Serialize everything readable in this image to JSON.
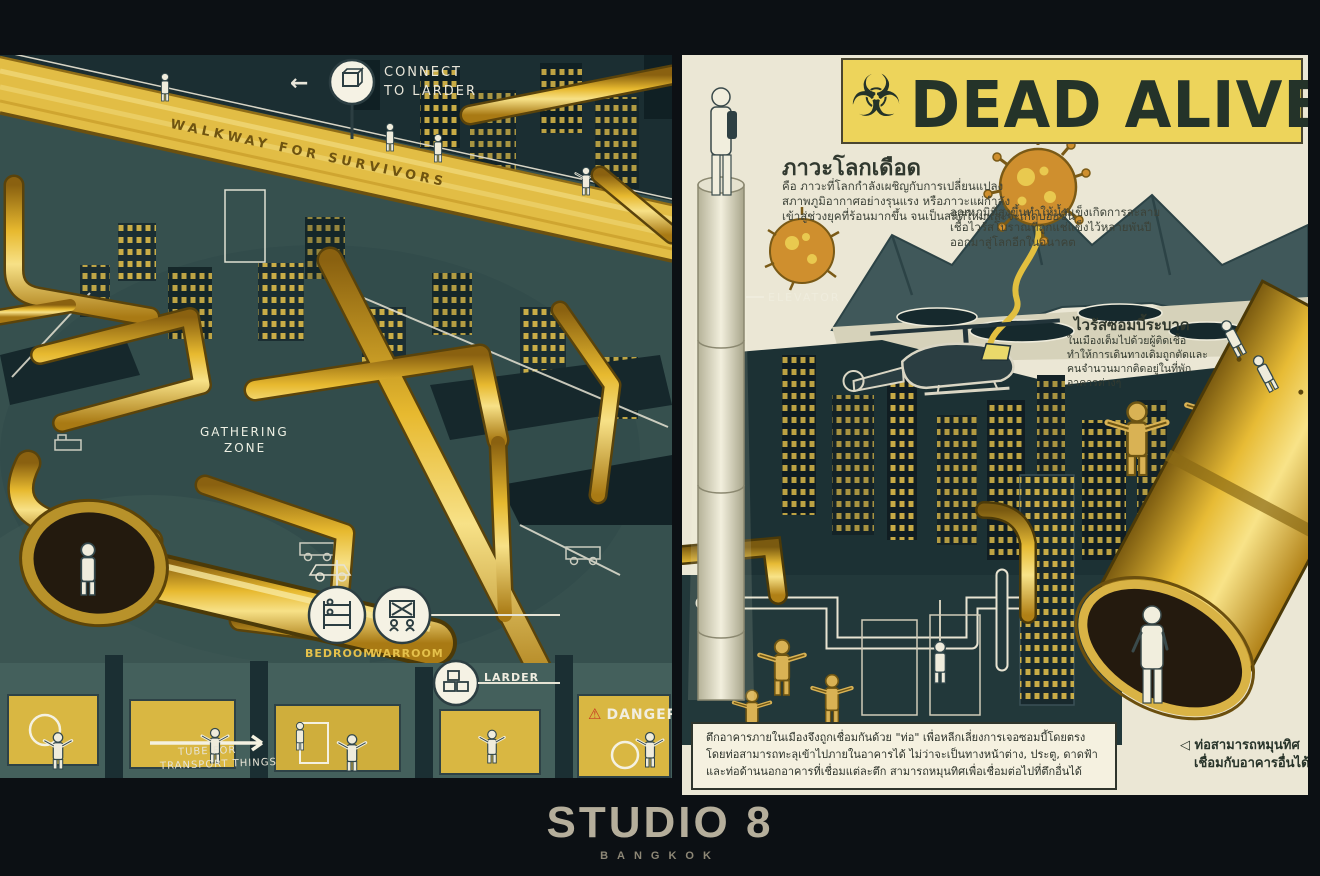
{
  "colors": {
    "background": "#0c1014",
    "pipe_gold": "#e2b93a",
    "scene_teal": "#36504e",
    "paper_cream": "#ebe7d5",
    "banner_yellow": "#edd45b",
    "title_ink": "#243329",
    "danger_red": "#c63b22",
    "studio_text": "#b5ae9b"
  },
  "icons": {
    "biohazard": "☣",
    "arrow_left": "←",
    "warning": "⚠"
  },
  "left_panel": {
    "connect_sign": {
      "line1": "CONNECT",
      "line2": "TO LARDER"
    },
    "walkway_label": "WALKWAY  FOR  SURVIVORS",
    "gathering_zone": {
      "line1": "GATHERING",
      "line2": "ZONE"
    },
    "stations": {
      "bedroom": "BEDROOM",
      "warroom": "WARROOM",
      "larder": "LARDER"
    },
    "danger_label": "DANGER",
    "tube_note": {
      "line1": "TUBE FOR",
      "line2": "TRANSPORT THINGS"
    }
  },
  "right_panel": {
    "title": "DEAD ALIVE",
    "global_boiling": {
      "heading": "ภาวะโลกเดือด",
      "lines": [
        "คือ ภาวะที่โลกกำลังเผชิญกับการเปลี่ยนแปลง",
        "สภาพภูมิอากาศอย่างรุนแรง หรือภาวะแผ่กำลัง",
        "เข้าสู่ช่วงยุคที่ร้อนมากขึ้น จนเป็นสถิติใหม่และจะเกิดบ่อยขึ้น"
      ]
    },
    "melt_note": {
      "lines": [
        "อุณหภูมิที่สูงขึ้นทำให้น้ำแข็งเกิดการละลาย",
        "เชื้อไวรัสโบราณที่ถูกแช่แข็งไว้หลายพันปี",
        "ออกมาสู่โลกอีกในอนาคต"
      ]
    },
    "elevator_label": "ELEVATOR",
    "zombie_outbreak": {
      "heading": "ไวรัสซอมบี้ระบาด",
      "lines": [
        "ในเมืองเต็มไปด้วยผู้ติดเชื้อ",
        "ทำให้การเดินทางเดิมถูกตัดและ",
        "คนจำนวนมากติดอยู่ในที่พัก",
        "อาคารต่างๆ"
      ]
    },
    "caption": {
      "lines": [
        "ตึกอาคารภายในเมืองจึงถูกเชื่อมกันด้วย \"ท่อ\" เพื่อหลีกเลี่ยงการเจอซอมบี้โดยตรง",
        "โดยท่อสามารถทะลุเข้าไปภายในอาคารได้ ไม่ว่าจะเป็นทางหน้าต่าง, ประตู, ดาดฟ้า",
        "และท่อด้านนอกอาคารที่เชื่อมแต่ละตึก สามารถหมุนทิศเพื่อเชื่อมต่อไปที่ตึกอื่นได้"
      ]
    },
    "tube_note": {
      "line1": "◁ ท่อสามารถหมุนทิศ",
      "line2": "เชื่อมกับอาคารอื่นได้"
    }
  },
  "footer": {
    "studio": "STUDIO 8",
    "city": "BANGKOK"
  }
}
